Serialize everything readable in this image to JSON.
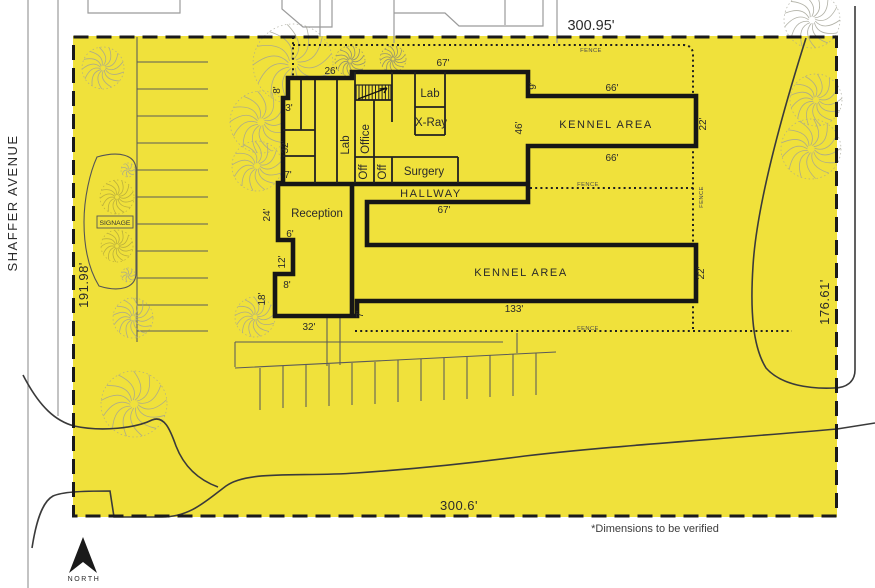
{
  "site": {
    "street_name": "SHAFFER AVENUE",
    "north_label": "NORTH",
    "note": "*Dimensions to be verified",
    "fence_label": "FENCE",
    "signage_label": "SIGNAGE",
    "boundary_dims": {
      "top": "300.95'",
      "left": "191.98'",
      "right": "176.61'",
      "bottom": "300.6'"
    },
    "colors": {
      "lot": "#f0e13b",
      "wall": "#161616",
      "gray_line": "#9b9b9b",
      "curb": "#3a3a3a"
    }
  },
  "rooms": [
    "Lab",
    "X-Ray",
    "Office",
    "Lab",
    "Off",
    "Off",
    "Surgery",
    "HALLWAY",
    "Reception",
    "KENNEL AREA",
    "KENNEL AREA"
  ],
  "building_dims": [
    "26'",
    "8'",
    "3'",
    "32'",
    "7'",
    "67'",
    "9'",
    "66'",
    "22'",
    "46'",
    "66'",
    "24'",
    "6'",
    "12'",
    "8'",
    "18'",
    "32'",
    "7'",
    "67'",
    "133'",
    "22'"
  ],
  "plan": {
    "labels": [
      {
        "t": "26'",
        "x": 331,
        "y": 74,
        "c": "d"
      },
      {
        "t": "8'",
        "x": 280,
        "y": 90,
        "r": 1,
        "c": "d"
      },
      {
        "t": "3'",
        "x": 289,
        "y": 111,
        "c": "d"
      },
      {
        "t": "32'",
        "x": 288,
        "y": 147,
        "r": 1,
        "c": "d"
      },
      {
        "t": "7'",
        "x": 288,
        "y": 178,
        "c": "d"
      },
      {
        "t": "67'",
        "x": 443,
        "y": 66,
        "c": "d"
      },
      {
        "t": "9'",
        "x": 536,
        "y": 86,
        "r": 1,
        "c": "d"
      },
      {
        "t": "66'",
        "x": 612,
        "y": 91,
        "c": "d"
      },
      {
        "t": "22'",
        "x": 706,
        "y": 124,
        "r": 1,
        "c": "d"
      },
      {
        "t": "46'",
        "x": 522,
        "y": 128,
        "r": 1,
        "c": "d"
      },
      {
        "t": "66'",
        "x": 612,
        "y": 161,
        "c": "d"
      },
      {
        "t": "24'",
        "x": 270,
        "y": 215,
        "r": 1,
        "c": "d"
      },
      {
        "t": "6'",
        "x": 290,
        "y": 237,
        "c": "d"
      },
      {
        "t": "12'",
        "x": 285,
        "y": 262,
        "r": 1,
        "c": "d"
      },
      {
        "t": "8'",
        "x": 287,
        "y": 288,
        "c": "d"
      },
      {
        "t": "18'",
        "x": 265,
        "y": 299,
        "r": 1,
        "c": "d"
      },
      {
        "t": "32'",
        "x": 309,
        "y": 330,
        "c": "d"
      },
      {
        "t": "7'",
        "x": 363,
        "y": 314,
        "r": 1,
        "c": "d"
      },
      {
        "t": "67'",
        "x": 444,
        "y": 213,
        "c": "d"
      },
      {
        "t": "133'",
        "x": 514,
        "y": 312,
        "c": "d"
      },
      {
        "t": "22'",
        "x": 704,
        "y": 273,
        "r": 1,
        "c": "d"
      },
      {
        "t": "Lab",
        "x": 430,
        "y": 97,
        "c": "r"
      },
      {
        "t": "X-Ray",
        "x": 431,
        "y": 126,
        "c": "r"
      },
      {
        "t": "Office",
        "x": 369,
        "y": 139,
        "r": 1,
        "c": "r"
      },
      {
        "t": "Lab",
        "x": 349,
        "y": 145,
        "r": 1,
        "c": "r"
      },
      {
        "t": "Off",
        "x": 367,
        "y": 172,
        "r": 1,
        "c": "r"
      },
      {
        "t": "Off",
        "x": 386,
        "y": 172,
        "r": 1,
        "c": "r"
      },
      {
        "t": "Surgery",
        "x": 424,
        "y": 175,
        "c": "r"
      },
      {
        "t": "Reception",
        "x": 317,
        "y": 217,
        "c": "r"
      },
      {
        "t": "HALLWAY",
        "x": 431,
        "y": 197,
        "c": "rl"
      },
      {
        "t": "KENNEL AREA",
        "x": 606,
        "y": 128,
        "c": "rl"
      },
      {
        "t": "KENNEL AREA",
        "x": 521,
        "y": 276,
        "c": "rl"
      },
      {
        "t": "300.95'",
        "x": 591,
        "y": 30,
        "c": "s14"
      },
      {
        "t": "SHAFFER AVENUE",
        "x": 17,
        "y": 203,
        "r": 1,
        "c": "s13ls"
      },
      {
        "t": "191.98'",
        "x": 88,
        "y": 285,
        "r": 1,
        "c": "s13"
      },
      {
        "t": "176.61'",
        "x": 829,
        "y": 302,
        "r": 1,
        "c": "s13"
      },
      {
        "t": "300.6'",
        "x": 459,
        "y": 510,
        "c": "s13"
      },
      {
        "t": "*Dimensions to be verified",
        "x": 655,
        "y": 532,
        "c": "note"
      },
      {
        "t": "NORTH",
        "x": 84,
        "y": 581,
        "c": "north"
      },
      {
        "t": "SIGNAGE",
        "x": 115,
        "y": 225,
        "c": "sign"
      },
      {
        "t": "FENCE",
        "x": 591,
        "y": 52,
        "c": "f"
      },
      {
        "t": "FENCE",
        "x": 588,
        "y": 186,
        "c": "f"
      },
      {
        "t": "FENCE",
        "x": 588,
        "y": 330,
        "c": "f"
      },
      {
        "t": "FENCE",
        "x": 703,
        "y": 197,
        "r": 1,
        "c": "f"
      }
    ],
    "trees": [
      {
        "x": 103,
        "y": 68,
        "r": 21,
        "k": "g"
      },
      {
        "x": 293,
        "y": 64,
        "r": 40,
        "k": "g"
      },
      {
        "x": 261,
        "y": 122,
        "r": 31,
        "k": "g"
      },
      {
        "x": 257,
        "y": 166,
        "r": 25,
        "k": "g"
      },
      {
        "x": 255,
        "y": 317,
        "r": 20,
        "k": "g"
      },
      {
        "x": 134,
        "y": 404,
        "r": 33,
        "k": "g"
      },
      {
        "x": 133,
        "y": 318,
        "r": 20,
        "k": "g"
      },
      {
        "x": 816,
        "y": 100,
        "r": 26,
        "k": "g"
      },
      {
        "x": 811,
        "y": 149,
        "r": 30,
        "k": "g"
      },
      {
        "x": 812,
        "y": 20,
        "r": 28,
        "k": "g"
      },
      {
        "x": 128,
        "y": 170,
        "r": 7,
        "k": "g"
      },
      {
        "x": 128,
        "y": 275,
        "r": 7,
        "k": "g"
      },
      {
        "x": 350,
        "y": 61,
        "r": 15,
        "k": "d"
      },
      {
        "x": 393,
        "y": 59,
        "r": 13,
        "k": "d"
      },
      {
        "x": 117,
        "y": 197,
        "r": 17,
        "k": "o"
      },
      {
        "x": 117,
        "y": 246,
        "r": 16,
        "k": "o"
      }
    ],
    "parking": {
      "left_stalls": {
        "x1": 137,
        "x2": 208,
        "ys": [
          62,
          89,
          116,
          143,
          170,
          197,
          224,
          251,
          278,
          305,
          331
        ]
      },
      "bottom_ticks": [
        [
          260,
          368
        ],
        [
          283,
          366
        ],
        [
          306,
          365
        ],
        [
          329,
          364
        ],
        [
          352,
          363
        ],
        [
          375,
          362
        ],
        [
          398,
          360
        ],
        [
          421,
          359
        ],
        [
          444,
          358
        ],
        [
          467,
          357
        ],
        [
          490,
          355
        ],
        [
          513,
          354
        ],
        [
          536,
          353
        ]
      ],
      "tick_len": 42
    }
  }
}
